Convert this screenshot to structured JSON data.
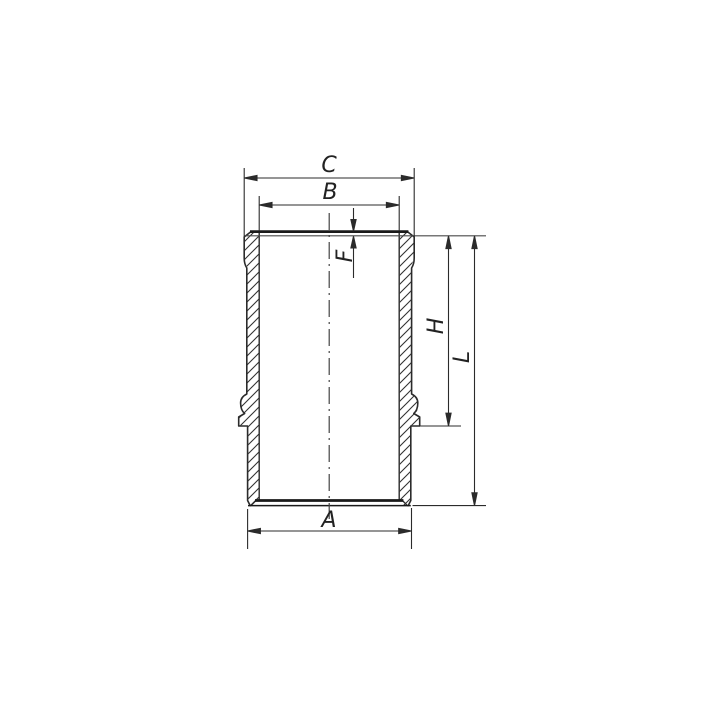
{
  "drawing": {
    "background_color": "#ffffff",
    "line_color": "#2b2b2b",
    "thick_line_color": "#1a1a1a",
    "hatch_color": "#333333",
    "labels": {
      "c": "C",
      "b": "B",
      "f": "F",
      "h": "H",
      "l": "L",
      "a": "A"
    }
  }
}
